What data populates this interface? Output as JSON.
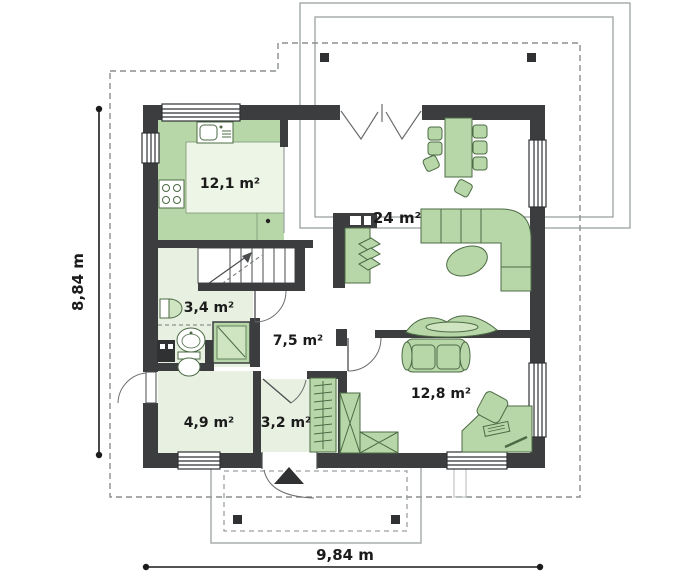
{
  "floorplan": {
    "rooms": [
      {
        "id": "kitchen",
        "area_label": "12,1 m²"
      },
      {
        "id": "living-room",
        "area_label": "24 m²"
      },
      {
        "id": "bathroom",
        "area_label": "3,4 m²"
      },
      {
        "id": "hall",
        "area_label": "7,5 m²"
      },
      {
        "id": "bedroom",
        "area_label": "12,8 m²"
      },
      {
        "id": "utility-room",
        "area_label": "4,9 m²"
      },
      {
        "id": "vestibule",
        "area_label": "3,2 m²"
      }
    ],
    "dimensions": {
      "height_label": "8,84 m",
      "width_label": "9,84 m"
    },
    "colors": {
      "wall": "#3b3d3f",
      "furniture_fill": "#b8d7a9",
      "furniture_outline": "#4c6b45",
      "floor_pale": "#e7f0e1",
      "floor_inner_light": "#ecf5e6",
      "outline_gray": "#9aa0a0",
      "dashed_gray": "#8a8f8f",
      "text": "#1b1b1b"
    }
  }
}
